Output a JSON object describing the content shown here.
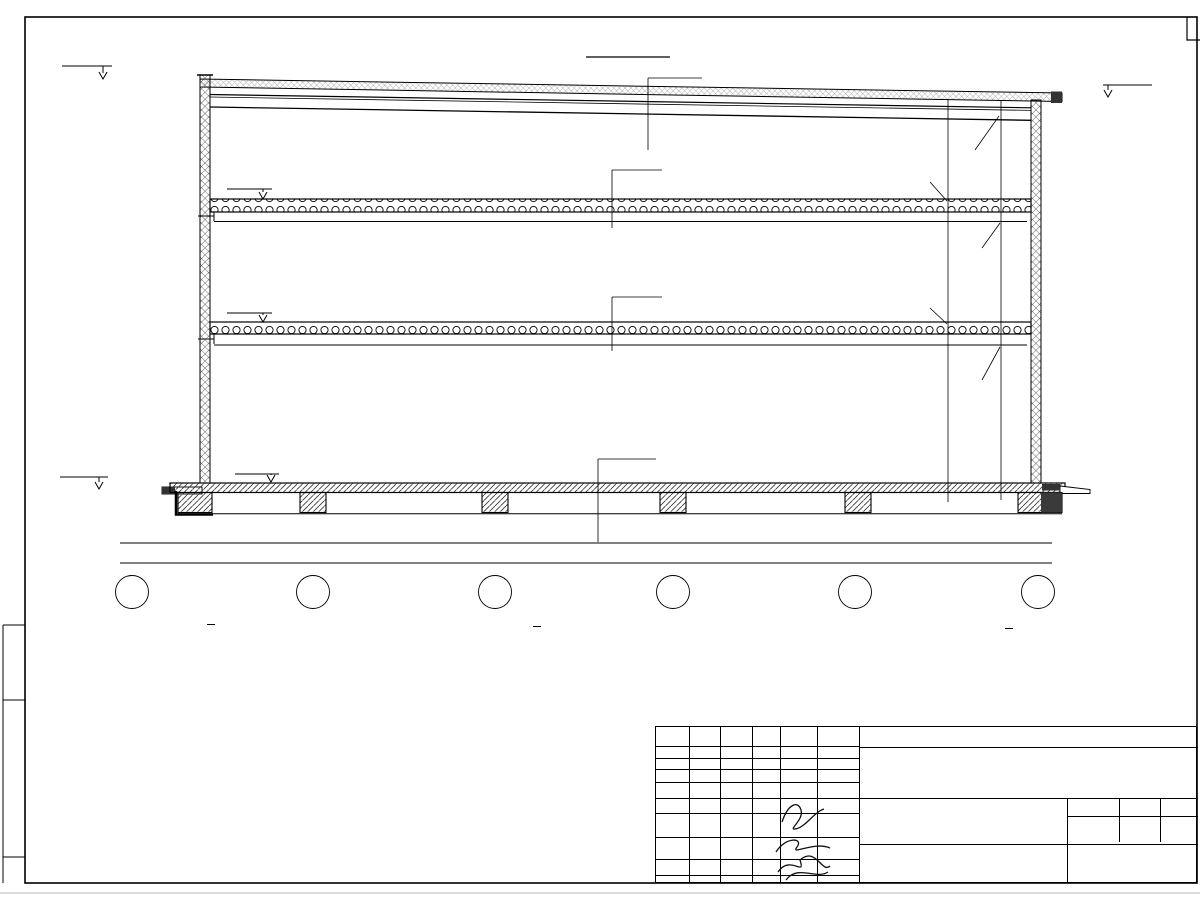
{
  "drawing": {
    "title": "Разрез 1-1",
    "elevations": {
      "parapet": "+14.150",
      "roof_right": "+12.976",
      "slab_upper": "+9.470",
      "slab_lower": "+5.350",
      "floor": "0.000",
      "ground_label": "Ур.зем."
    },
    "composition_labels": {
      "roof": "Состав 3",
      "slab_upper": "Состав 2",
      "slab_lower": "Состав 2",
      "floor": "Состав 1"
    },
    "right_dims": {
      "d220a": "220",
      "d3311": "3311",
      "d450": "450",
      "d2631": "2631",
      "d770a": "770",
      "d3900": "3900",
      "d3350": "3350",
      "d220b": "220",
      "d770b": "770",
      "d5133": "5133",
      "d4582": "4582"
    },
    "bottom_dims": {
      "spans": [
        "6000",
        "6000",
        "6000",
        "6000",
        "6000"
      ],
      "total": "30000"
    },
    "grid": [
      "2",
      "3",
      "4",
      "5",
      "6",
      "7"
    ]
  },
  "compositions": [
    {
      "title": "Состав 1",
      "items": [
        {
          "label": "- Железобетонная  монолитная плита\nиз бетона В 15 (М200)",
          "value": "- 150 мм"
        },
        {
          "label": "- Сетка армирующая Ø5 100х100 мм",
          "value": ""
        },
        {
          "label": "- Пленка полиэтиленовая",
          "value": "-  2 слоя"
        },
        {
          "label": "- Подготовка из песка средней\nкрупности",
          "value": "- 200 мм"
        },
        {
          "label": "- Грунт основания",
          "value": ""
        }
      ]
    },
    {
      "title": "Состав 3",
      "items": [
        {
          "label": "- Мембрана ПВХ",
          "value": "- 1 слой"
        },
        {
          "label": "- Геотекстиль",
          "value": "- 1 слой"
        },
        {
          "label": "- Утеплитель ПЕНОПЛЭКС,\nтолщиной 50 мм",
          "value": "- 3 слоя"
        },
        {
          "label": "- Утеплитель Эковер Y=100 кг/м3,\nтолщиной 50 мм",
          "value": "- 1 слой"
        },
        {
          "label": "- Пароизоляция для плоских кровель",
          "value": "- 1 слой"
        },
        {
          "label": "- Профлист Н 35х0.7 мм",
          "value": ""
        },
        {
          "label": "- Металлические прогоны",
          "value": ""
        },
        {
          "label": "- Металлическая балка",
          "value": ""
        }
      ]
    },
    {
      "title": "Состав 2",
      "items": [
        {
          "label": "- Сборные ж/б плиты перекрытия",
          "value": "- 220 мм"
        },
        {
          "label": "- Металлическая фермы (с торцов балки)",
          "value": ""
        }
      ]
    }
  ],
  "note": "1. Разрез 1-1 замаркирован см. л. АР-17, АР-18, АР-19, АР-20.",
  "titleblock": {
    "doc_number": "19-23П",
    "project_line1": "\"Здание склада\", расположенное по адресу:",
    "project_line2": "Московская область, г. Москва, Дмитровское шоссе,163 ж",
    "columns": {
      "izm": "Изм.",
      "kol": "Кол.",
      "list": "Лист",
      "doc": "№док.",
      "podp": "Подп.",
      "data": "Дата"
    },
    "rows": [
      {
        "role": "Разработал",
        "name": "Решетова",
        "date": "04.23"
      },
      {
        "role": "Н. контр.",
        "name": "Двоеглазов",
        "date": "04.23"
      },
      {
        "role": "ГИП",
        "name": "Коротаев",
        "date": "04.23"
      }
    ],
    "organization": "ООО \"ИндигоЛаб РУС\"",
    "sheet_title": "Разрез 1-1",
    "firm": "ООО \"Альянс\"",
    "stage_label": "Стадия",
    "sheet_label": "Лист",
    "sheets_label": "Листов",
    "stage": "ЭП",
    "sheet_no": "21",
    "sheets_total": "23"
  }
}
